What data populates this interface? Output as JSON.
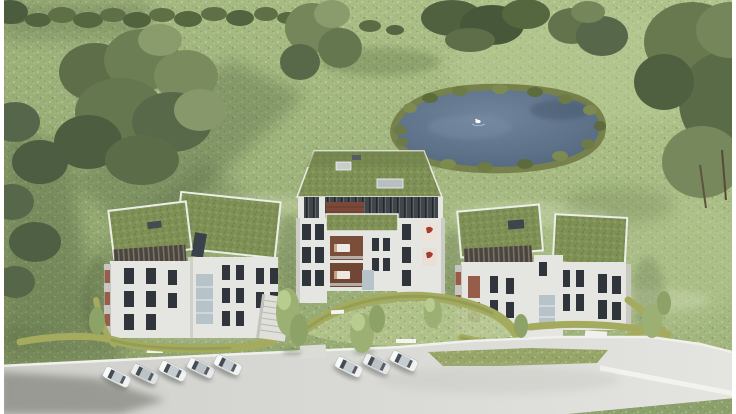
{
  "scene": {
    "name": "aerial-architectural-render-residential-development",
    "palette": {
      "grassDark": "#87986a",
      "grassLight": "#aebf8a",
      "treeDark": "#4d5e40",
      "treeMid": "#6c7e53",
      "treeLight": "#87996a",
      "hedgeOlive": "#a4ab5f",
      "pondWater": "#5d7188",
      "pondReed": "#77814b",
      "roofGreen": "#7f9156",
      "facadeWhite": "#e5e5e1",
      "facadeShade": "#c7c6c1",
      "claddingDark": "#4a453e",
      "windowDark": "#2f353a",
      "windowWarm": "#965d49",
      "glassBlue": "#b6c3c9",
      "roadGrey": "#d7d7d3",
      "rampWall": "#f0f0ed",
      "carWhite": "#f1f2f1",
      "swanWhite": "#ffffff",
      "frameWhite": "#ffffff"
    },
    "landscape": {
      "meadow_flowers": true,
      "tree_groups": 6,
      "hedgerow_top": true,
      "pond": {
        "swan_count": 1,
        "reed_border": true
      }
    },
    "buildings": [
      {
        "name": "left-apartment-block",
        "facade": "light-grey",
        "roof": "green-extensive",
        "penthouse_cladding": "dark-timber-slats",
        "visible_floors": 4
      },
      {
        "name": "central-apartment-block",
        "facade": "light-grey",
        "roof": "green-hipped",
        "balconies": "warm-timber",
        "visible_floors": 5
      },
      {
        "name": "right-apartment-block",
        "facade": "light-grey",
        "roof": "green-extensive",
        "penthouse_cladding": "dark-timber-slats",
        "visible_floors": 4
      }
    ],
    "site": {
      "parking_cars": 8,
      "car_rows": [
        5,
        3
      ],
      "road": "light-concrete",
      "ramp": "curved-driveway-with-white-walls",
      "benches": 3,
      "stairs": 1
    },
    "frame": {
      "left_border_px": 4,
      "right_border_px": 4
    }
  }
}
